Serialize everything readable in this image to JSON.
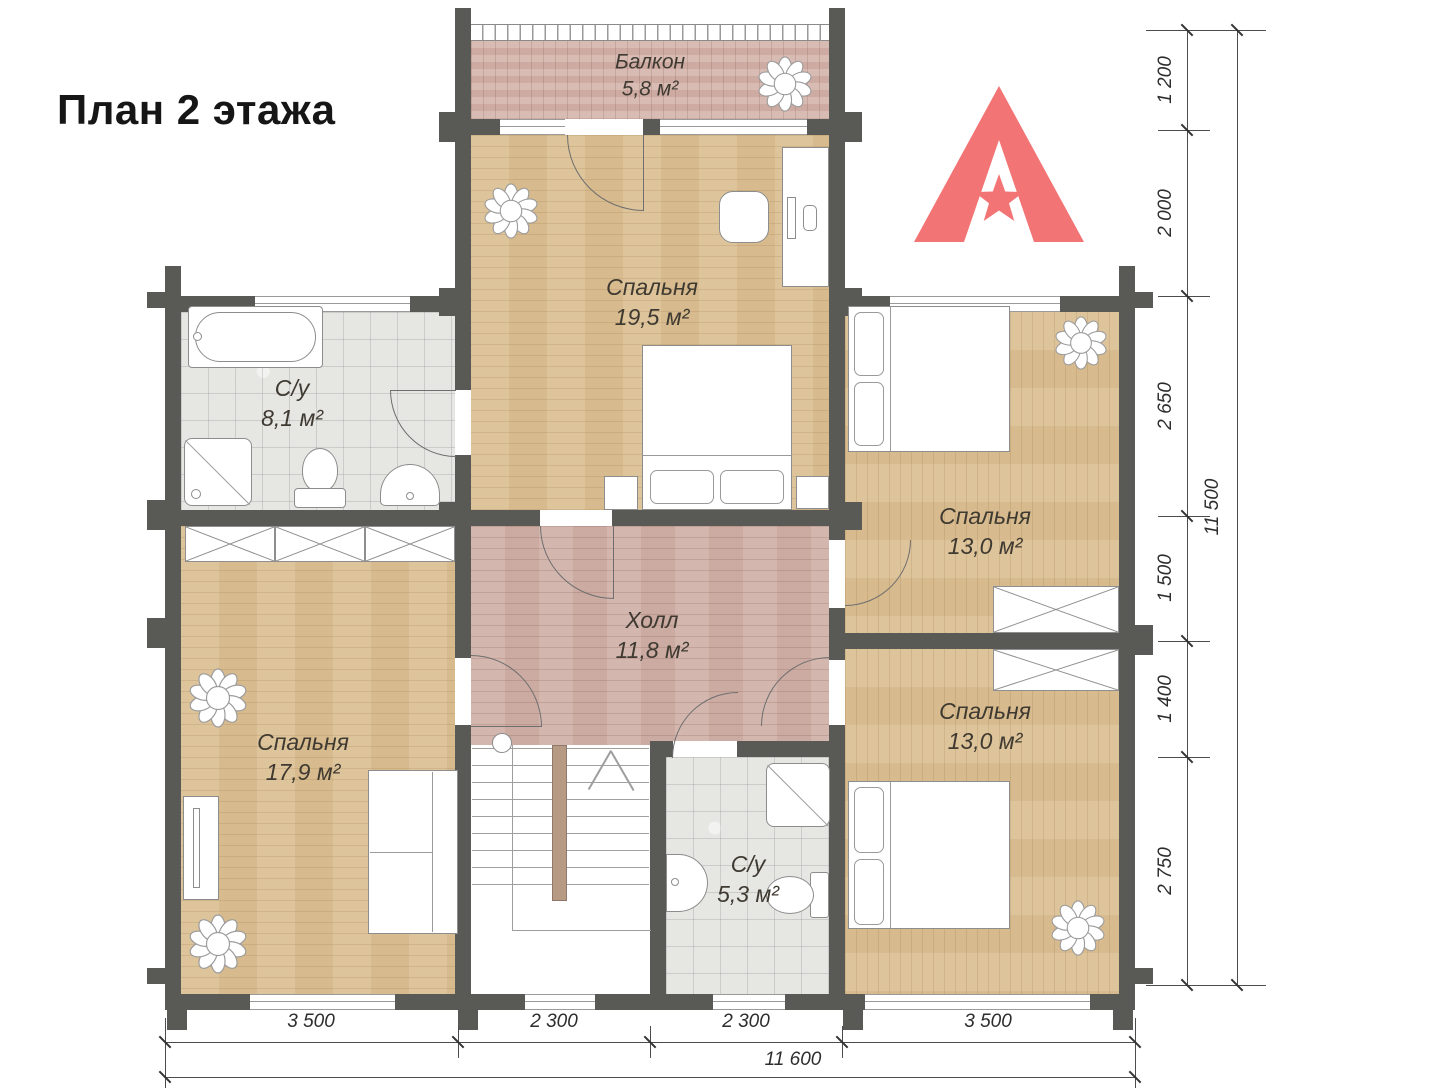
{
  "title": "План 2 этажа",
  "logo": {
    "brand": "ALMAZ WOOD"
  },
  "rooms": {
    "balcony": {
      "name": "Балкон",
      "area": "5,8 м²"
    },
    "bedroom_top": {
      "name": "Спальня",
      "area": "19,5 м²"
    },
    "bathroom_left": {
      "name": "С/у",
      "area": "8,1 м²"
    },
    "bedroom_right_top": {
      "name": "Спальня",
      "area": "13,0 м²"
    },
    "hall": {
      "name": "Холл",
      "area": "11,8 м²"
    },
    "bedroom_left": {
      "name": "Спальня",
      "area": "17,9 м²"
    },
    "bathroom_bottom": {
      "name": "С/у",
      "area": "5,3 м²"
    },
    "bedroom_right_bottom": {
      "name": "Спальня",
      "area": "13,0 м²"
    }
  },
  "dimensions": {
    "right": [
      "1 200",
      "2 000",
      "2 650",
      "1 500",
      "1 400",
      "2 750"
    ],
    "right_total": "11 500",
    "bottom": [
      "3 500",
      "2 300",
      "2 300",
      "3 500"
    ],
    "bottom_total": "11 600"
  },
  "colors": {
    "wall": "#595955",
    "wood_floor": "#dcc093",
    "terrace_floor": "#d3b3aa",
    "tile_floor": "#e6e6e3",
    "logo_accent": "#f37474"
  }
}
